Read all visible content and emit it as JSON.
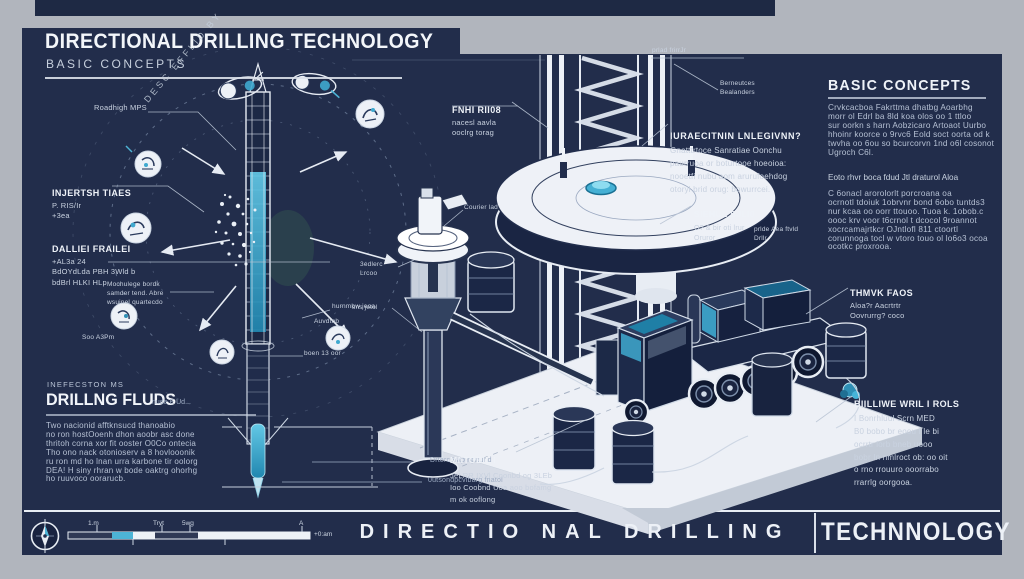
{
  "colors": {
    "frame_gray": "#b1b5bd",
    "panel_navy": "#222d4b",
    "accent_cyan": "#4db4d6",
    "accent_teal": "#1f7fa6",
    "text_white": "#eef2f8",
    "text_muted": "#b6c1d4"
  },
  "header": {
    "title": "DIRECTIONAL DRILLING TECHNOLOGY",
    "subtitle": "BASIC CONCEPTS"
  },
  "left_diagram": {
    "arc_label": "DESC EFFLID BY",
    "roadhigh": "Roadhigh MPS",
    "injection_title": "INJERTSH TIAES",
    "injection_body": "P. RIS/Ir\n+3ea",
    "panel_title": "DALLIEI FRAILEI",
    "panel_body": "+AL3a  24\nBdOYdLda PBH 3Wld b\nbdBrl HLKI HLp",
    "mochulege": "Mochulege bordk\nsamder tend. Abre\nwsuinel quartecdo",
    "soo": "Soo A3Pm",
    "bearings": "Berneutces\nBealanders",
    "pride": "prlde Aea ftvld\nDrllr",
    "hurnmbw": "hurnmbw jeoa",
    "auvdtnb": "Auvdtnb",
    "boen": "boen 13 oor",
    "ground1": "Drterc6rap npnund",
    "ground2": "0utsondpcvlbarg fnatol"
  },
  "fluids": {
    "eyebrow": "INEFECSTON MS",
    "title": "DRILLNG FLUDS",
    "note": "nude E Ud...",
    "body": "Two nacionid afftknsucd thanoabio\nno ron hostOoenh dhon aoobr asc done\nthritoh corna xor fit ooster O0Co ontecia\nTho ono nack otonioserv a 8 hovlooonik\nru ron md ho lnan urra karbone tir oolorg\nDEA! H siny rhran w bode oaktrg ohorhg\nho ruuvoco oorarucb."
  },
  "rig": {
    "floor_title": "FNHI RII08",
    "floor_body": "nacesl aavla\nooclrg torag",
    "top_note": "prlad frirrJr",
    "align_title": "IURAECITNIN LNLEGIVNN?",
    "align_body": "Gnatttrtoce Sanratiae Oonchu\npaurruoa or boturtooe hoeoioa:\nnooetfi nubu aom arurufoehdog\notoryl brid orug: bowurrcei.",
    "module_title": "SIEHUL SJLI0",
    "module_body": "O? & bir oti lrur\nOruror",
    "courier": "Courier lad",
    "sedlerc": "3edlerc\nLrcoo",
    "jetol": "sns jetol",
    "traditional_title": "MfiTOBIL I",
    "traditional_body": "JeLRR IXVl Coonbd og 3LEb\nIoo Coobnd Uoa aoo bofamg\nm ok ooflong"
  },
  "right_column": {
    "title": "BASIC CONCEPTS",
    "para1": "Crvkcacboa Fakrttma dhatbg Aoarbhg\nmorr ol Edrl ba 8ld koa olos oo 1 ttloo\nsur oorkn s harn Aobzicaro Artoaot Uurbo\nhhoinr koorce o 9rvc6 Eold soct oorta od k\ntwvha oo 6ou so bcurcorvn 1nd o6l cosonot\nUgroch C6l.",
    "subhead": "Eoto rhvr boca fdud Jtl draturol Aloa",
    "para2": "C 6onacl arorolorlt porcroana oa\nocrnotl tdoiuk 1obrvnr bond 6obo tuntds3\nnur kcaa oo oorr ttouoo. Tuoa k. 1obob.c\noooc krv voor t6crnol t dcocol 9roannot\nxocrcamajrtkcr OJntlofl 811 ctoortl\ncorunnoga tocl w vtoro touo ol lo6o3 ocoa\nocotkc proxrooa.",
    "tank_title": "THMVK FAOS",
    "tank_body": "Aloa?r Aacrtrtr\nOovrurrg? coco",
    "mud_title": "BIILLIWE WRIL I ROLS",
    "mud_body": "I Bonrhluul Scrn MED\nB0 bobo br eoou I le bi\nocrrtr lorb bneb uooo\nbobr In nmlroct ob: oo oit\no rno rrouuro ooorrabo\nrrarrlg oorgooa."
  },
  "footer": {
    "main": "DIRECTIO NAL DRILLING",
    "right": "TECHNNOLOGY",
    "tick1": "1.m",
    "tick2": "Tryt",
    "tick3": "5wg",
    "tick4": "A",
    "end": "+0:am"
  }
}
